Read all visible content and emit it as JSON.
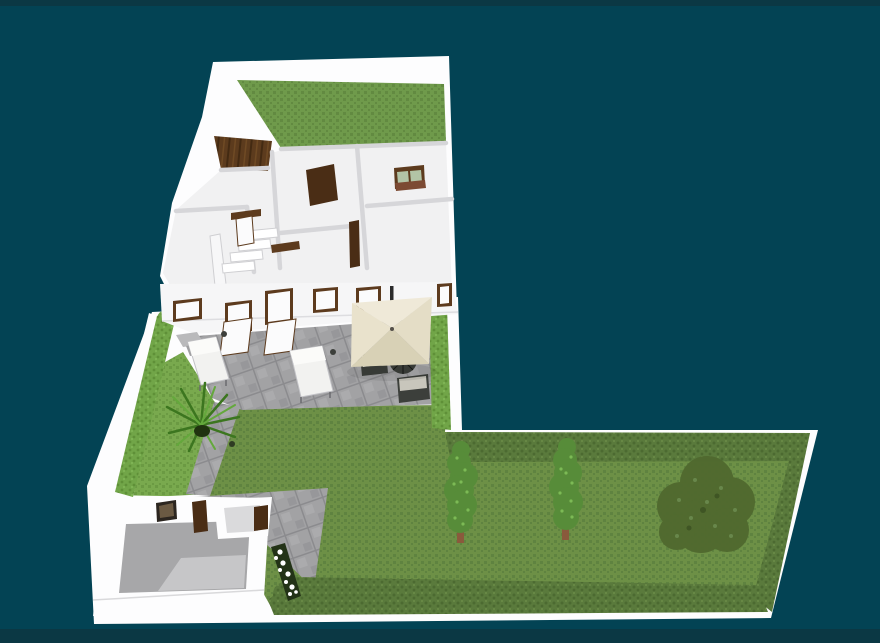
{
  "scene": {
    "objects": [
      "property-platform",
      "house-block",
      "back-garden-lawn",
      "wood-deck",
      "interior-rooms",
      "staircase",
      "interior-doors",
      "bedroom-window",
      "house-front-wall",
      "open-door-panels",
      "terrace-paving",
      "garden-path",
      "driveway-paving",
      "side-lawn",
      "main-lawn",
      "garage",
      "annex-room",
      "wall-picture",
      "flower-planter",
      "boundary-hedges",
      "conifer-trees",
      "bush-tree",
      "palm-plant",
      "sun-loungers",
      "parasol",
      "patio-furniture"
    ]
  },
  "colors": {
    "background": "#034354",
    "frame_strip": "#0b3844",
    "white": "#ffffff",
    "wall_white": "#fdfdfe",
    "wall_face": "#f6f6f7",
    "wall_shadow": "#d6d6d9",
    "floor_interior": "#f1f1f2",
    "backlawn_base": "#6f9a4b",
    "backlawn_dot": "#628a41",
    "lawn_base": "#6d9046",
    "lawn_dot": "#5f8340",
    "patch_base": "#79a94e",
    "patch_dot": "#6b9a43",
    "hedge_bright": "#71a548",
    "hedge_bright_dark": "#5f9038",
    "hedge_olive": "#5a7a3c",
    "hedge_olive_dark": "#4c6a31",
    "patio_base": "#a2a2a4",
    "patio_joint": "#8b8b8e",
    "garage_floor": "#a7a7a9",
    "garage_floor_light": "#c6c6c8",
    "annex_floor": "#dadadc",
    "wood_base": "#5c3b1d",
    "wood_dark": "#432a12",
    "door_dark": "#4a2d15",
    "door_frame": "#5d3b1e",
    "glass": "#b2c4a6",
    "sill": "#7c4a33",
    "umbrella_top": "#efe9d8",
    "umbrella_right": "#e4ddc6",
    "umbrella_bottom": "#d8d1b6",
    "umbrella_left": "#e9e2cc",
    "pole": "#2b2b2b",
    "furniture_dark": "#3c3f3b",
    "cushion": "#f4f3ee",
    "stool_top": "#c8c6bc",
    "tree_conifer": "#578c39",
    "conifer_light": "#7cba55",
    "trunk": "#8a5a3c",
    "tree_bush": "#50692f",
    "bush_light": "#68874b",
    "bush_dark": "#3f5524",
    "planter": "#233317",
    "flower": "#ffffff",
    "palm_dark": "#3c761f",
    "palm_light": "#64a83c",
    "palm_center": "#20330f",
    "lounger": "#f2f2f0",
    "lounger_frame": "#c2c2c6",
    "picture_frame": "#2c2620",
    "picture_inner": "#6b5a43"
  }
}
